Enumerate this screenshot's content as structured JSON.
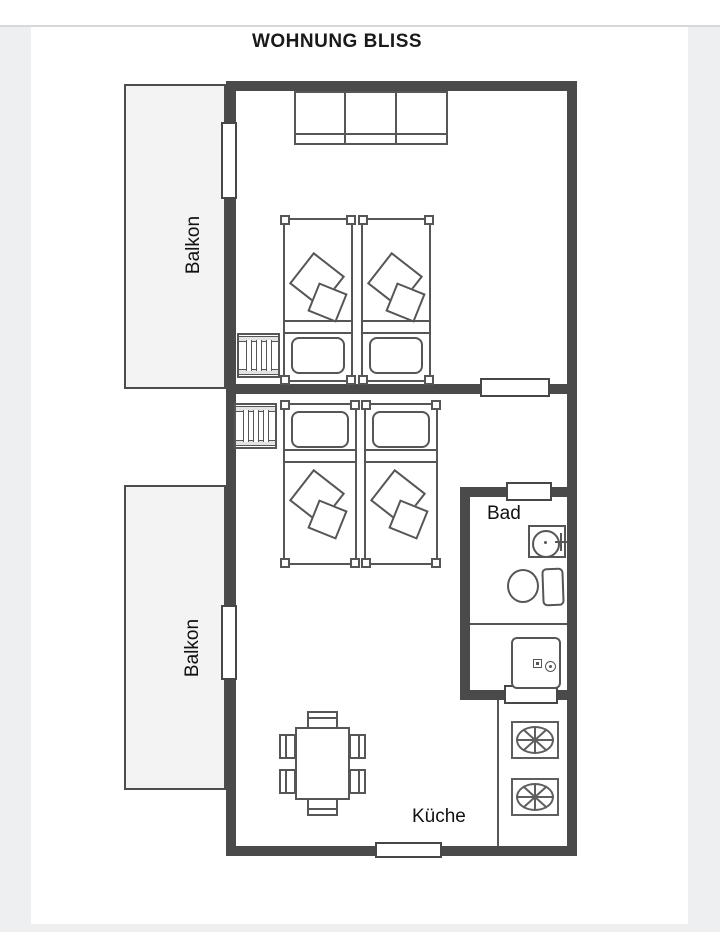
{
  "title": "WOHNUNG BLISS",
  "labels": {
    "balcony_top": "Balkon",
    "balcony_bottom": "Balkon",
    "bathroom": "Bad",
    "kitchen": "Küche"
  },
  "colors": {
    "wall": "#4a4a4a",
    "line": "#565656",
    "balcony_fill": "#f3f3f3",
    "page": "#ffffff",
    "frame": "#edeff1",
    "title_text": "#1a1a1a"
  }
}
